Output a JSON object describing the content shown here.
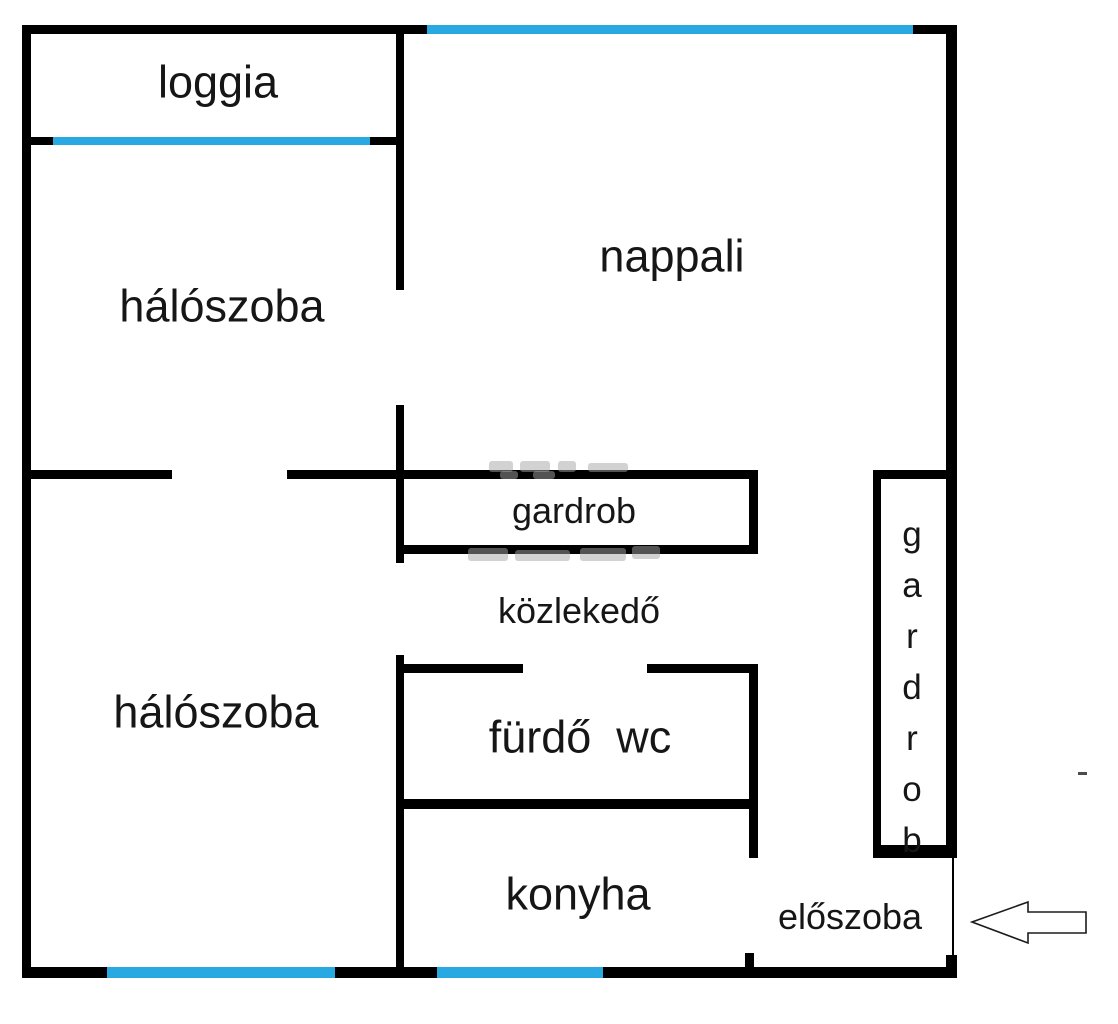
{
  "colors": {
    "background": "#ffffff",
    "wall": "#000000",
    "window": "#29a9e1",
    "ink": "#161616",
    "watermark": "#a6a6a6"
  },
  "rooms": {
    "loggia": {
      "label": "loggia"
    },
    "nappali": {
      "label": "nappali"
    },
    "haloszoba_top": {
      "label": "hálószoba"
    },
    "haloszoba_bottom": {
      "label": "hálószoba"
    },
    "gardrob_middle": {
      "label": "gardrob"
    },
    "kozlekedo": {
      "label": "közlekedő"
    },
    "furdo_wc": {
      "label": "fürdő  wc"
    },
    "konyha": {
      "label": "konyha"
    },
    "eloszoba": {
      "label": "előszoba"
    },
    "gardrob_right": {
      "label": "gardrob"
    }
  },
  "entrance_arrow": {
    "direction": "left"
  }
}
